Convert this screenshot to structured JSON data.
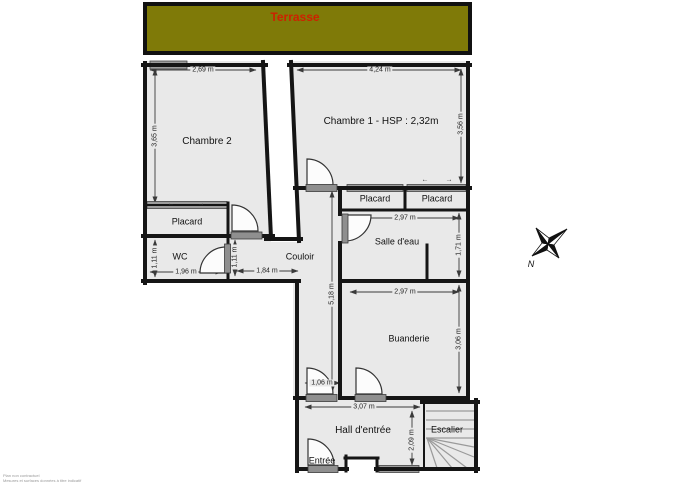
{
  "terrace": {
    "label": "Terrasse"
  },
  "rooms": {
    "chambre2": "Chambre 2",
    "chambre1": "Chambre 1 - HSP : 2,32m",
    "placard_chambre2": "Placard",
    "wc": "WC",
    "couloir": "Couloir",
    "placard1": "Placard",
    "placard2": "Placard",
    "salle_eau": "Salle d'eau",
    "buanderie": "Buanderie",
    "hall": "Hall d'entrée",
    "entree": "Entrée",
    "escalier": "Escalier"
  },
  "dimensions": {
    "chambre2_width": "2,69 m",
    "chambre2_height": "3,65 m",
    "chambre1_width": "4,24 m",
    "chambre1_height": "3,56 m",
    "wc_width": "1,96 m",
    "wc_height": "1,11 m",
    "couloir_branch_height": "1,11 m",
    "couloir_branch_width": "1,84 m",
    "couloir_length": "5,18 m",
    "salle_eau_width": "2,97 m",
    "salle_eau_height": "1,71 m",
    "buanderie_width": "2,97 m",
    "buanderie_height": "3,06 m",
    "hall_passage_width": "1,06 m",
    "hall_width": "3,07 m",
    "hall_height": "2,09 m"
  },
  "compass": {
    "north": "N"
  },
  "icons": {
    "slide_left": "←",
    "slide_right": "→"
  },
  "colors": {
    "terrace_fill": "#7f7a08",
    "terrace_text": "#cc2200",
    "wall": "#151515",
    "floor": "#e9e9e9"
  },
  "watermark": {
    "line1": "Plan non contractuel",
    "line2": "Mesures et surfaces données à titre indicatif"
  }
}
